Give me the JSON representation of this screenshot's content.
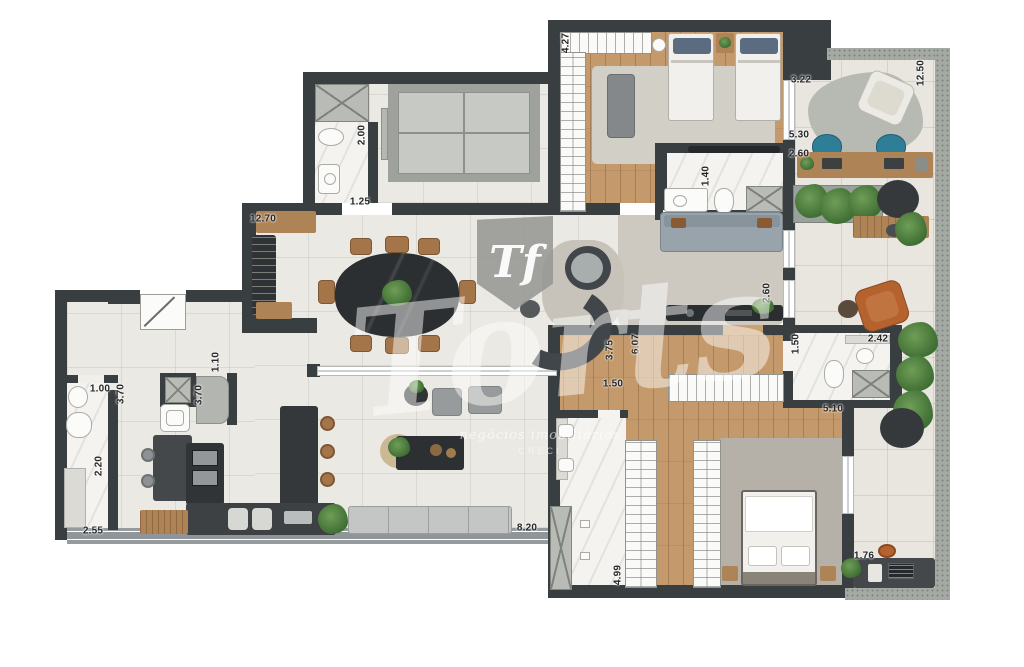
{
  "watermark": {
    "monogram": "Tf",
    "brand": "Torts",
    "tagline": "negócios imobiliários",
    "registry": "CRECI"
  },
  "measurements": [
    {
      "value": "2.00",
      "x": 362,
      "y": 135,
      "dir": "v"
    },
    {
      "value": "1.25",
      "x": 360,
      "y": 202,
      "dir": "h"
    },
    {
      "value": "12.70",
      "x": 263,
      "y": 219,
      "dir": "h"
    },
    {
      "value": "4.27",
      "x": 566,
      "y": 43,
      "dir": "v"
    },
    {
      "value": "3.22",
      "x": 801,
      "y": 80,
      "dir": "h"
    },
    {
      "value": "12.50",
      "x": 921,
      "y": 73,
      "dir": "v"
    },
    {
      "value": "5.30",
      "x": 799,
      "y": 135,
      "dir": "h"
    },
    {
      "value": "1.40",
      "x": 706,
      "y": 176,
      "dir": "v"
    },
    {
      "value": "2.60",
      "x": 799,
      "y": 154,
      "dir": "h"
    },
    {
      "value": "2.60",
      "x": 767,
      "y": 293,
      "dir": "v"
    },
    {
      "value": "6.07",
      "x": 636,
      "y": 344,
      "dir": "v"
    },
    {
      "value": "3.75",
      "x": 610,
      "y": 350,
      "dir": "v"
    },
    {
      "value": "1.50",
      "x": 613,
      "y": 384,
      "dir": "h"
    },
    {
      "value": "1.50",
      "x": 796,
      "y": 344,
      "dir": "v"
    },
    {
      "value": "2.42",
      "x": 878,
      "y": 339,
      "dir": "h"
    },
    {
      "value": "5.10",
      "x": 833,
      "y": 409,
      "dir": "h"
    },
    {
      "value": "1.10",
      "x": 216,
      "y": 362,
      "dir": "v"
    },
    {
      "value": "1.00",
      "x": 100,
      "y": 389,
      "dir": "h"
    },
    {
      "value": "3.70",
      "x": 121,
      "y": 394,
      "dir": "v"
    },
    {
      "value": "3.70",
      "x": 199,
      "y": 395,
      "dir": "v"
    },
    {
      "value": "2.20",
      "x": 99,
      "y": 466,
      "dir": "v"
    },
    {
      "value": "2.55",
      "x": 93,
      "y": 531,
      "dir": "h"
    },
    {
      "value": "8.20",
      "x": 527,
      "y": 528,
      "dir": "h"
    },
    {
      "value": "4.99",
      "x": 618,
      "y": 575,
      "dir": "v"
    },
    {
      "value": "1.76",
      "x": 864,
      "y": 556,
      "dir": "h"
    }
  ],
  "colors": {
    "wall": "#393e41",
    "wood_floor": "#c49a6c",
    "tile_floor": "#ebe9e3",
    "marble_floor": "#f4f3f0",
    "balcony_floor": "#e8e6df",
    "balcony_border": "#a4aaa3",
    "chair_blue": "#2f7e97",
    "chair_terracotta": "#b5622e",
    "plant_green": "#4d7a3a"
  }
}
